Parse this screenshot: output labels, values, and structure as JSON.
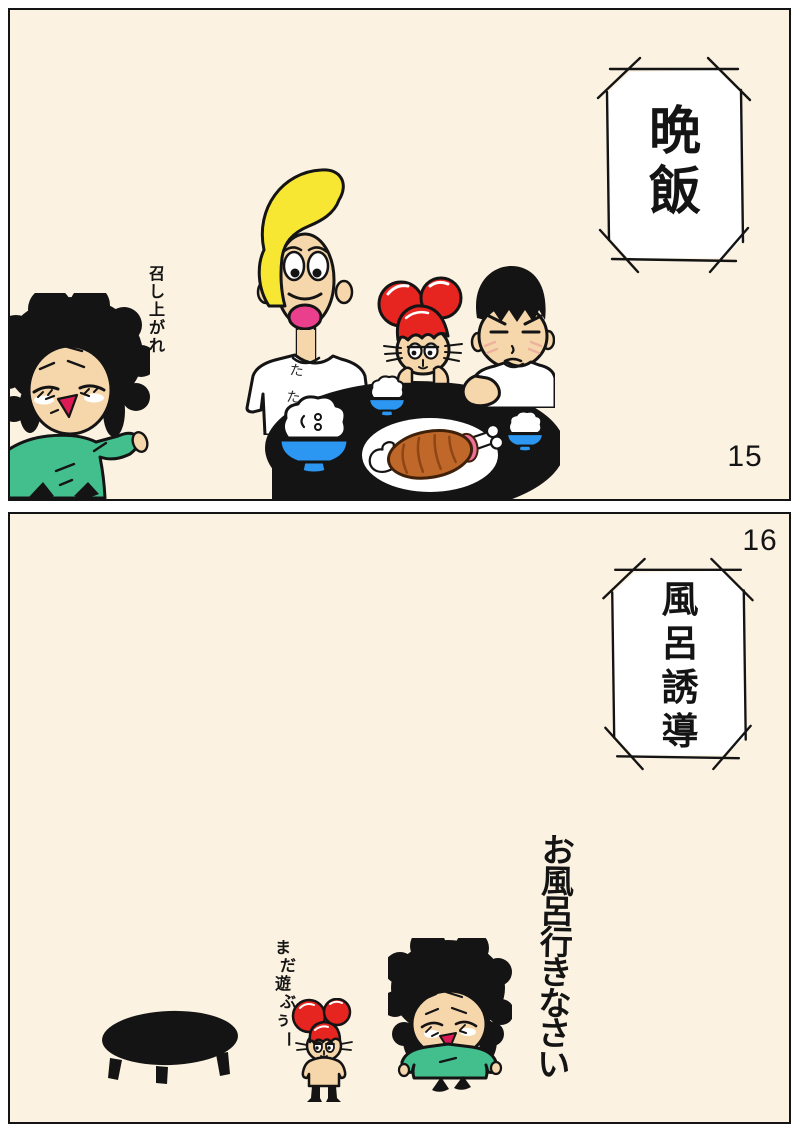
{
  "page": {
    "type": "comic-strip",
    "panel_count": 2
  },
  "colors": {
    "page_bg": "#ffffff",
    "panel_bg": "#fbf2e1",
    "ink": "#141414",
    "skin": "#f6d6ab",
    "green_shirt": "#43bf8e",
    "blonde_hair": "#f7e733",
    "hat_red": "#e62521",
    "bowl_blue": "#2b97f2",
    "meat_brown": "#c0682a",
    "meat_dark": "#3f2008",
    "meat_stripe": "#8f4514",
    "meat_flesh_pink": "#ee6f9b",
    "mouth_red": "#dc1a55",
    "mouth_pink": "#ea3f8d",
    "blush_pink": "#edb29e"
  },
  "panel1": {
    "number": "15",
    "title": "晩飯",
    "mom_line": "召し上がれ",
    "dad_shirt": "たた"
  },
  "panel2": {
    "number": "16",
    "title": "風呂誘導",
    "mom_line": "お風呂行きなさい",
    "kid_line": "まだ遊ぶぅー"
  }
}
